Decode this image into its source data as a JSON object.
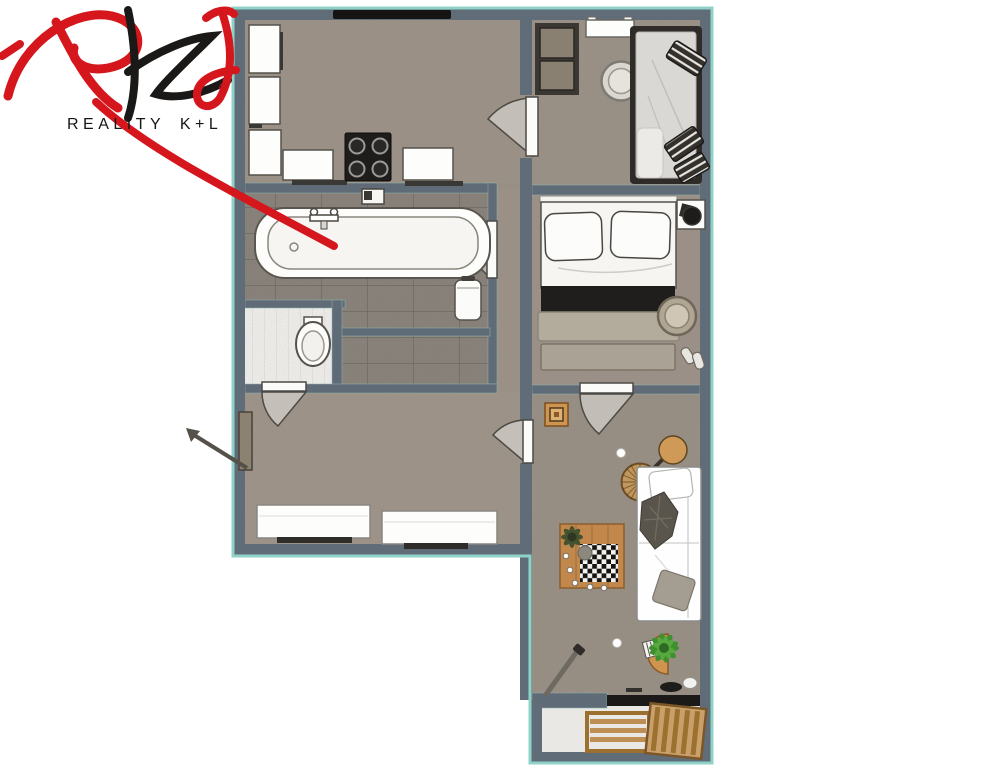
{
  "logo": {
    "company_name": "REALITY K+L",
    "registered_mark": "®",
    "script_monogram": "RkL",
    "brand_red": "#d6161d",
    "brand_black": "#1b1917"
  },
  "palette": {
    "background": "#ffffff",
    "wall": "#606d78",
    "outer_outline_teal": "#8fd2c7",
    "floor_main": "#9c9288",
    "floor_bathroom": "#87817a",
    "floor_wc": "#efeeec",
    "floor_balcony": "#e9e8e4",
    "furniture_white": "#fdfdfb",
    "furniture_dark": "#2e2b28",
    "wood": "#c1874b",
    "window_black": "#1b1a18",
    "plant_green": "#3f8f2f"
  },
  "floor_plan": {
    "type": "apartment-floor-plan-top-view",
    "rooms": [
      {
        "id": "kitchen",
        "furniture": [
          "window",
          "tall-cabinet-column",
          "counter-left",
          "cooktop-4-burners",
          "counter-right",
          "wall-sink"
        ]
      },
      {
        "id": "small-bedroom",
        "furniture": [
          "wardrobe-2-door",
          "wall-shelf",
          "round-side-table",
          "single-bed",
          "striped-pillows"
        ]
      },
      {
        "id": "main-bedroom",
        "furniture": [
          "double-bed",
          "two-pillows",
          "black-runner",
          "foot-bench",
          "fan-on-side-table",
          "round-side-table",
          "slippers"
        ]
      },
      {
        "id": "bathroom",
        "furniture": [
          "bathtub",
          "faucet",
          "laundry-bin",
          "wall-fixture"
        ]
      },
      {
        "id": "wc",
        "furniture": [
          "toilet"
        ]
      },
      {
        "id": "hallway",
        "furniture": [
          "entrance-door",
          "sideboard-left",
          "sideboard-right"
        ]
      },
      {
        "id": "living-room",
        "furniture": [
          "wooden-stool",
          "guitar",
          "rattan-rug",
          "sofa",
          "throw-blanket",
          "gray-cushion",
          "chess-coffee-table",
          "table-plant",
          "half-round-plant-table",
          "potted-plant",
          "leaning-pole",
          "window-sill-items"
        ]
      },
      {
        "id": "balcony",
        "furniture": [
          "wooden-lounger"
        ]
      }
    ],
    "doors": [
      "entrance-door",
      "kitchen-small-bedroom-door",
      "bathroom-door",
      "wc-door",
      "hallway-living-door",
      "main-bedroom-door"
    ]
  }
}
